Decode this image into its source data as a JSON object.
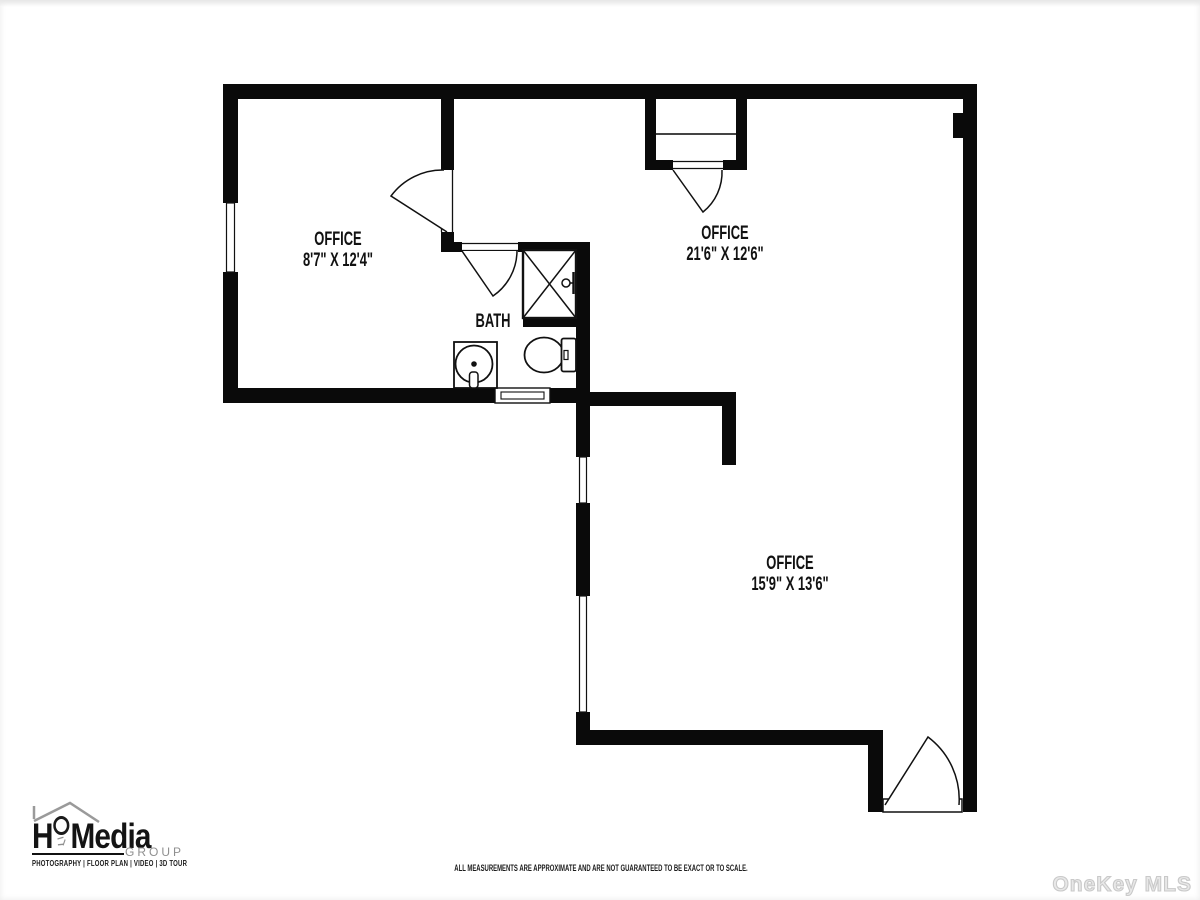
{
  "plan": {
    "rooms": [
      {
        "label": "OFFICE",
        "dims": "8'7\" X 12'4\""
      },
      {
        "label": "OFFICE",
        "dims": "21'6\" X 12'6\""
      },
      {
        "label": "OFFICE",
        "dims": "15'9\" X 13'6\""
      },
      {
        "label": "BATH",
        "dims": ""
      }
    ]
  },
  "branding": {
    "logo_prefix": "H",
    "logo_suffix": "Media",
    "logo_sub": "GROUP",
    "logo_tagline": "PHOTOGRAPHY | FLOOR PLAN | VIDEO | 3D TOUR"
  },
  "footer": {
    "disclaimer": "ALL MEASUREMENTS ARE APPROXIMATE AND ARE NOT GUARANTEED TO BE EXACT OR TO SCALE."
  },
  "watermark": {
    "text": "OneKey MLS"
  },
  "colors": {
    "wall": "#0a0a0a",
    "line": "#111111",
    "logo_gray": "#8f8f8f",
    "watermark_gray": "#c9c9c9"
  }
}
